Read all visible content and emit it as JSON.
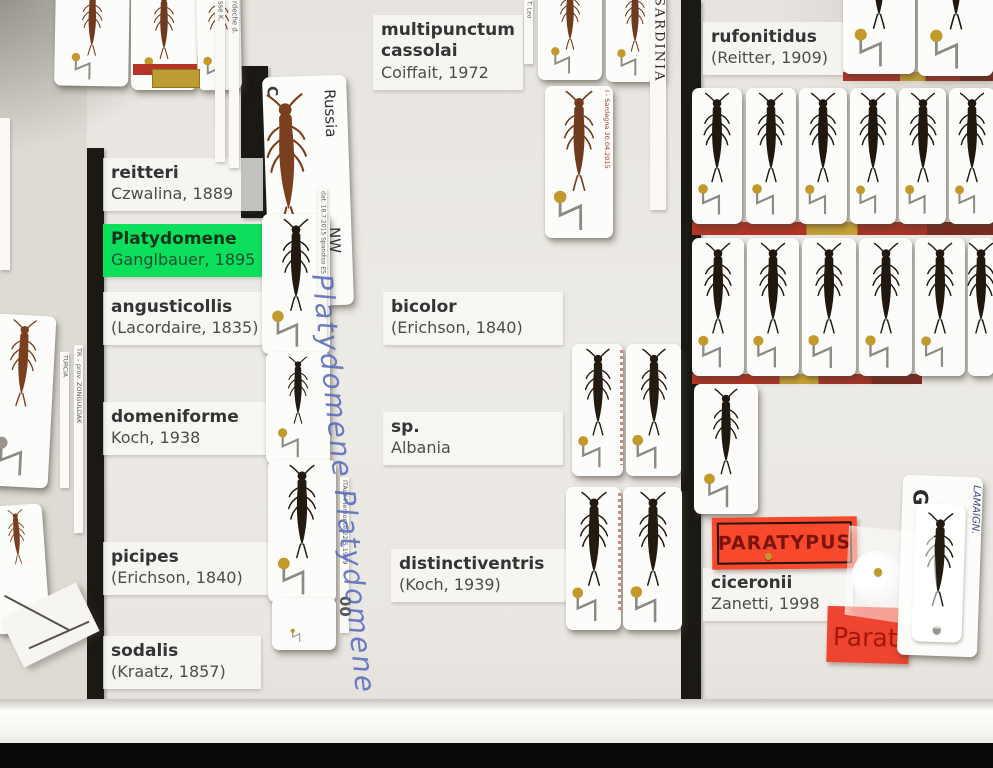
{
  "species_labels": {
    "reitteri": {
      "name": "reitteri",
      "author": "Czwalina, 1889"
    },
    "platydomene": {
      "name": "Platydomene",
      "author": "Ganglbauer, 1895"
    },
    "angusticollis": {
      "name": "angusticollis",
      "author": "(Lacordaire, 1835)"
    },
    "domeniforme": {
      "name": "domeniforme",
      "author": "Koch, 1938"
    },
    "picipes": {
      "name": "picipes",
      "author": "(Erichson, 1840)"
    },
    "sodalis": {
      "name": "sodalis",
      "author": "(Kraatz, 1857)"
    },
    "multipunctum": {
      "name": "multipunctum cassolai",
      "author": "Coiffait, 1972"
    },
    "bicolor": {
      "name": "bicolor",
      "author": "(Erichson, 1840)"
    },
    "sp_albania": {
      "name": "sp.",
      "author": "Albania"
    },
    "distinctiventris": {
      "name": "distinctiventris",
      "author": "(Koch, 1939)"
    },
    "rufonitidus": {
      "name": "rufonitidus",
      "author": "(Reitter, 1909)"
    },
    "ciceronii": {
      "name": "ciceronii",
      "author": "Zanetti, 1998"
    }
  },
  "type_labels": {
    "paratypus": "PARATYPUS",
    "paratypus_partial": "Paraty"
  },
  "locality_labels": {
    "russia": "Russia",
    "russia_region": "NW",
    "russia_corner": "C",
    "sardinia": "SARDINIA",
    "sardegna_date": "I - Sardegna 30.04.2015",
    "leo": "T. Leo",
    "spandiso": "dat. 18.7.2015 Spandiso ES",
    "piemonte": "ITALY Piemonte 22.5.1999",
    "turcia": "TURCIA",
    "zonguldak": "TR – prov. ZONGULDAK",
    "ardeche_a": "sse K.",
    "ardeche_b": "rdeche d.",
    "g_mark": "G",
    "lamaign": "LAMAIGN.",
    "pin_number": "00"
  },
  "handwriting": {
    "platydomene_script": "Platydomene Platydomene"
  },
  "colors": {
    "genus_highlight": "#0BDF5C",
    "type_label_red": "#F8492C",
    "divider_black": "#1B1914",
    "pin_brass": "#C19A2B"
  }
}
